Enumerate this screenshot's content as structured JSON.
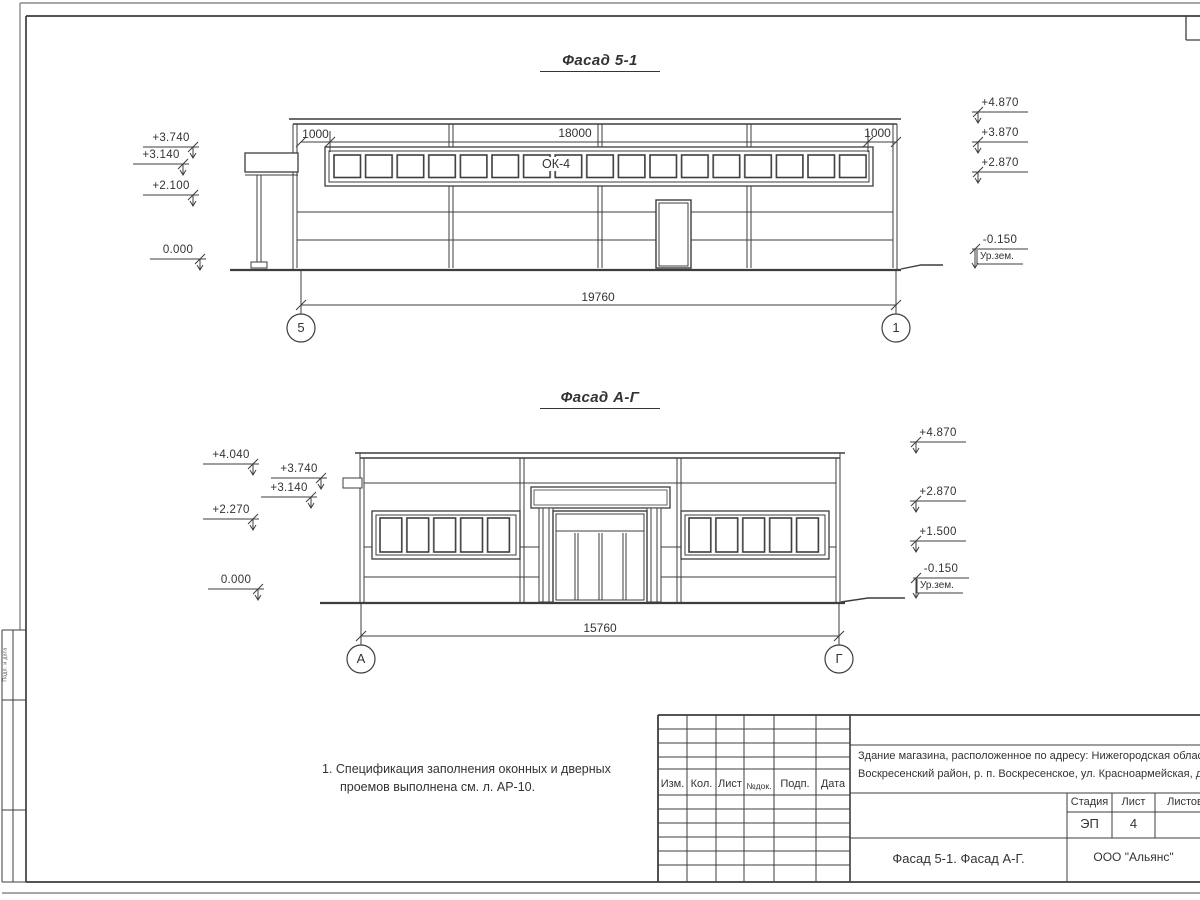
{
  "sheet": {
    "note_line1": "1. Спецификация заполнения оконных и дверных",
    "note_line2": "проемов выполнена см. л. АР-10.",
    "margin_stamp": "Подп. и дата"
  },
  "facade1": {
    "title": "Фасад 5-1",
    "window_label": "ОК-4",
    "dims": {
      "left": "1000",
      "mid": "18000",
      "right": "1000",
      "total": "19760"
    },
    "axes": {
      "left": "5",
      "right": "1"
    },
    "marks_left": [
      "+3.740",
      "+3.140",
      "+2.100",
      "0.000"
    ],
    "marks_right": [
      "+4.870",
      "+3.870",
      "+2.870",
      "-0.150"
    ],
    "ground_label": "Ур.зем."
  },
  "facade2": {
    "title": "Фасад А-Г",
    "dims": {
      "total": "15760"
    },
    "axes": {
      "left": "А",
      "right": "Г"
    },
    "marks_left": [
      "+4.040",
      "+3.740",
      "+3.140",
      "+2.270",
      "0.000"
    ],
    "marks_right": [
      "+4.870",
      "+2.870",
      "+1.500",
      "-0.150"
    ],
    "ground_label": "Ур.зем."
  },
  "titleblock": {
    "rev_headers": [
      "Изм.",
      "Кол.",
      "Лист",
      "№док.",
      "Подп.",
      "Дата"
    ],
    "project_line1": "Здание магазина, расположенное по адресу: Нижегородская область,",
    "project_line2": "Воскресенский район, р. п. Воскресенское, ул. Красноармейская, д. 1",
    "stage_label": "Стадия",
    "sheet_label": "Лист",
    "sheets_label": "Листов",
    "stage_value": "ЭП",
    "sheet_value": "4",
    "drawing_title": "Фасад 5-1. Фасад А-Г.",
    "company": "ООО \"Альянс\""
  }
}
